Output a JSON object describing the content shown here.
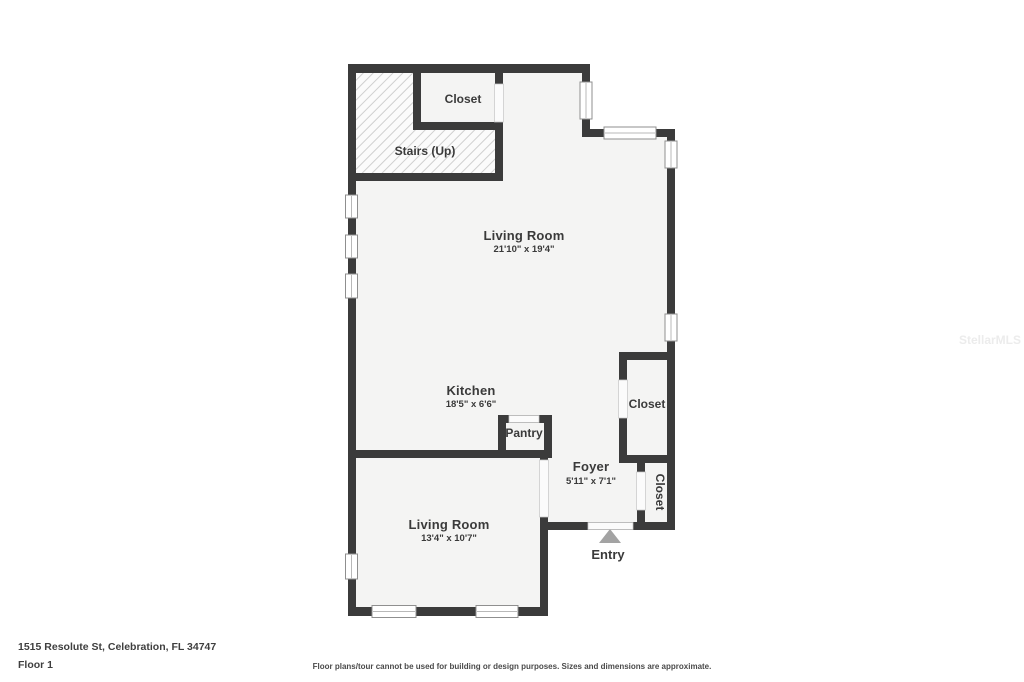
{
  "floorplan": {
    "address": "1515 Resolute St, Celebration, FL 34747",
    "floor_label": "Floor 1",
    "disclaimer": "Floor plans/tour cannot be used for building or design purposes. Sizes and dimensions are approximate.",
    "watermark": "StellarMLS",
    "entry_label": "Entry",
    "rooms": [
      {
        "name": "Closet",
        "dimensions": ""
      },
      {
        "name": "Stairs (Up)",
        "dimensions": ""
      },
      {
        "name": "Living Room",
        "dimensions": "21'10\" x 19'4\""
      },
      {
        "name": "Kitchen",
        "dimensions": "18'5\" x 6'6\""
      },
      {
        "name": "Pantry",
        "dimensions": ""
      },
      {
        "name": "Closet",
        "dimensions": ""
      },
      {
        "name": "Foyer",
        "dimensions": "5'11\" x 7'1\""
      },
      {
        "name": "Closet",
        "dimensions": ""
      },
      {
        "name": "Living Room",
        "dimensions": "13'4\" x 10'7\""
      }
    ],
    "colors": {
      "wall": "#3b3b3b",
      "floor": "#f4f4f3",
      "entry_arrow": "#a3a3a3",
      "hatch_line": "#cfcfcf"
    }
  }
}
